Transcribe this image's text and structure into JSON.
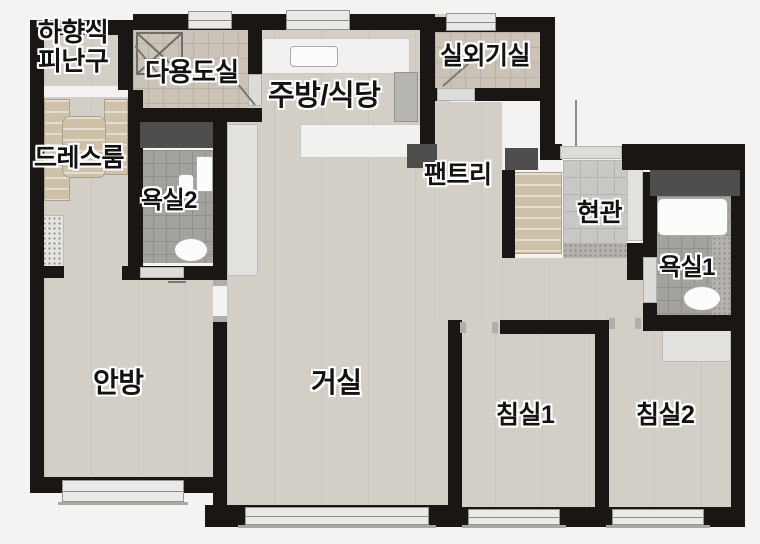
{
  "floorplan": {
    "rooms": {
      "escape_hatch": "하향식\n피난구",
      "utility": "다용도실",
      "kitchen_dining": "주방/식당",
      "outdoor_unit": "실외기실",
      "dress_room": "드레스룸",
      "bath2": "욕실2",
      "pantry": "팬트리",
      "entrance": "현관",
      "bath1": "욕실1",
      "master_bedroom": "안방",
      "living_room": "거실",
      "bedroom1": "침실1",
      "bedroom2": "침실2"
    },
    "colors": {
      "background": "#f4f3f1",
      "wall": "#1a1613",
      "wood_floor": "#d3cfc7",
      "bath_tile": "#a3a29e",
      "utility_tile": "#cbc3b7",
      "entrance_tile": "#cac8c5",
      "duct": "#4f4e4c",
      "counter": "#f2f1ef",
      "label_text": "#131210",
      "label_outline": "#ffffff"
    }
  }
}
